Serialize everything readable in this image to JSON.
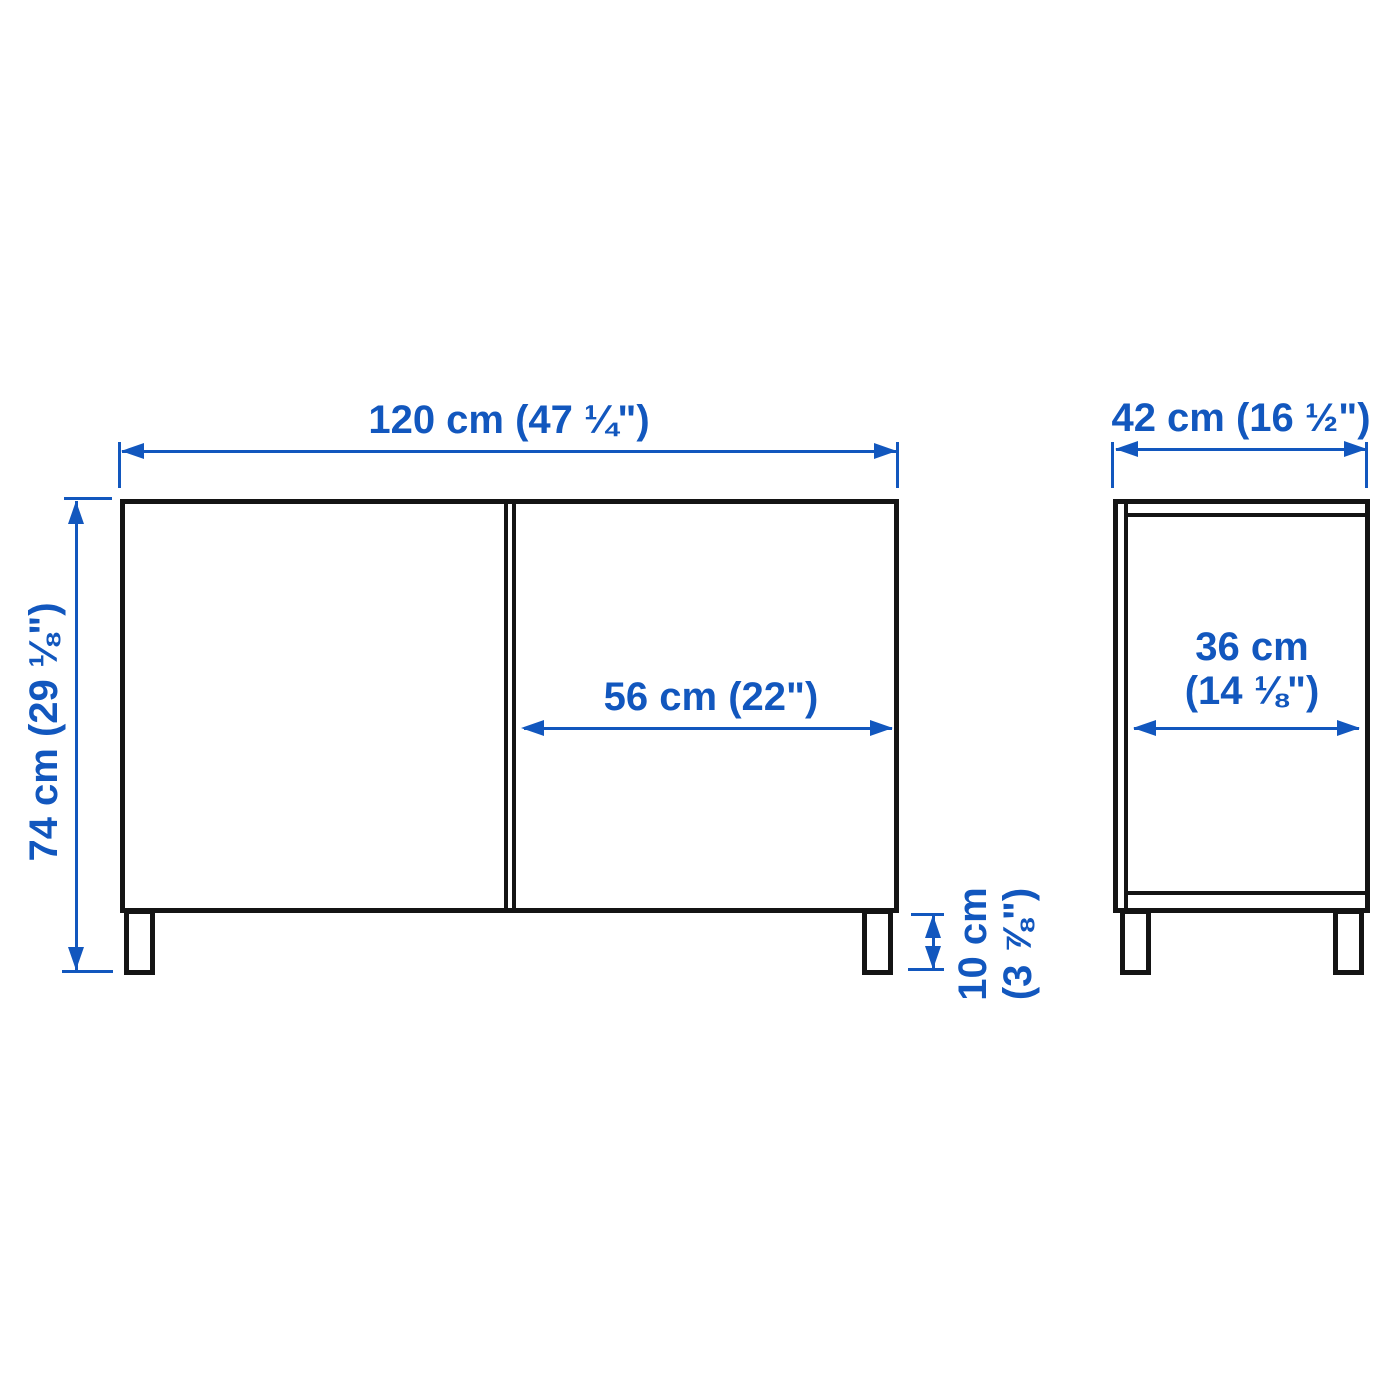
{
  "diagram_type": "furniture dimension drawing (front and side view)",
  "colors": {
    "dimension_blue": "#1257be",
    "outline_black": "#141414",
    "background": "#ffffff"
  },
  "front_view": {
    "width": "120 cm (47 ¼\")",
    "height": "74 cm (29 ⅛\")",
    "door_width": "56 cm (22\")",
    "leg_height": [
      "10 cm",
      "(3 ⅞\")"
    ]
  },
  "side_view": {
    "depth": "42 cm (16 ½\")",
    "inner_depth": [
      "36 cm",
      "(14 ⅛\")"
    ]
  }
}
